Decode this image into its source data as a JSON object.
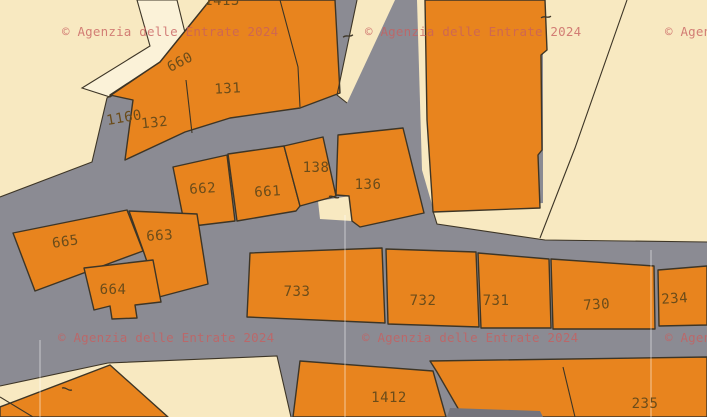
{
  "map": {
    "title": "cadastral-map",
    "watermark": {
      "text": "© Agenzia delle Entrate 2024",
      "positions": [
        [
          62,
          36
        ],
        [
          365,
          36
        ],
        [
          665,
          36
        ],
        [
          58,
          342
        ],
        [
          362,
          342
        ],
        [
          665,
          342
        ]
      ]
    },
    "colors": {
      "road": "#8b8b93",
      "road_dark": "#74747c",
      "land": "#f8e9c1",
      "land_light": "#fbf2d8",
      "parcel": "#e8841e",
      "boundary": "#3d3526",
      "label": "#6b4c1a",
      "watermark": "#c85f5f",
      "grid": "#ffffff"
    },
    "land_areas": [
      {
        "name": "land-area-northwest",
        "points": "0,0 210,0 160,62 107,98 92,162 0,197"
      },
      {
        "name": "land-area-top-wedge",
        "points": "357,0 395,0 347,103 337,95"
      },
      {
        "name": "land-area-road-sliver",
        "points": "417,0 425,0 433,208 422,170"
      },
      {
        "name": "land-area-east",
        "points": "543,0 707,0 707,242 545,240 437,224 433,211 543,203"
      },
      {
        "name": "land-area-notch",
        "points": "318,201 350,196 352,221 320,219"
      },
      {
        "name": "land-area-south",
        "points": "108,363 277,356 291,417 165,417 110,366"
      },
      {
        "name": "land-area-south-strip",
        "points": "0,386 108,363 112,367 0,406"
      }
    ],
    "corridors": [
      {
        "name": "footpath-corridor",
        "points": "137,0 177,0 190,53 162,63 110,97 82,88 150,46"
      }
    ],
    "parcels": [
      {
        "label": "131",
        "points": "210,0 335,0 340,93 300,108 230,118 185,132 125,160 133,100 110,95 160,62",
        "lx": 228,
        "ly": 93,
        "rot": -3
      },
      {
        "label": "",
        "points": "425,0 545,0 547,50 541,55 542,150 538,155 540,208 433,212 427,120",
        "lx": 0,
        "ly": 0,
        "rot": 0
      },
      {
        "label": "662",
        "points": "173,167 227,155 235,221 185,227",
        "lx": 203,
        "ly": 193,
        "rot": -4
      },
      {
        "label": "661",
        "points": "228,154 284,146 300,206 296,211 237,221",
        "lx": 268,
        "ly": 196,
        "rot": -4
      },
      {
        "label": "138",
        "points": "284,146 323,137 336,196 318,201 300,206",
        "lx": 316,
        "ly": 172,
        "rot": 0
      },
      {
        "label": "136",
        "points": "338,135 403,128 424,213 360,227 352,221 349,196 336,195",
        "lx": 368,
        "ly": 189,
        "rot": 0
      },
      {
        "label": "665",
        "points": "13,233 127,210 143,251 35,291",
        "lx": 66,
        "ly": 246,
        "rot": -8
      },
      {
        "label": "663",
        "points": "129,211 197,214 208,284 159,297 143,250",
        "lx": 160,
        "ly": 240,
        "rot": -4
      },
      {
        "label": "664",
        "points": "84,268 153,260 161,302 135,305 137,318 112,319 110,306 94,310",
        "lx": 113,
        "ly": 294,
        "rot": 0
      },
      {
        "label": "733",
        "points": "250,253 382,248 385,323 247,317",
        "lx": 297,
        "ly": 296,
        "rot": 0
      },
      {
        "label": "732",
        "points": "386,249 476,252 479,327 388,324",
        "lx": 423,
        "ly": 305,
        "rot": 0
      },
      {
        "label": "731",
        "points": "478,253 549,259 551,328 481,328",
        "lx": 496,
        "ly": 305,
        "rot": 0
      },
      {
        "label": "730",
        "points": "551,259 654,266 655,329 553,329",
        "lx": 597,
        "ly": 309,
        "rot": -4
      },
      {
        "label": "234",
        "points": "658,270 707,266 707,325 659,326",
        "lx": 675,
        "ly": 303,
        "rot": -4
      },
      {
        "label": "",
        "points": "0,407 110,365 168,417 0,417",
        "lx": 0,
        "ly": 0,
        "rot": 0
      },
      {
        "label": "1412",
        "points": "300,361 433,371 446,417 293,417",
        "lx": 389,
        "ly": 402,
        "rot": 0
      },
      {
        "label": "235",
        "points": "430,361 707,357 707,417 463,417 437,372",
        "lx": 645,
        "ly": 408,
        "rot": 0
      }
    ],
    "extra_labels": [
      {
        "text": "1413",
        "x": 222,
        "y": 5,
        "rot": 0
      },
      {
        "text": "660",
        "x": 182,
        "y": 66,
        "rot": -27
      },
      {
        "text": "1160",
        "x": 125,
        "y": 122,
        "rot": -10
      },
      {
        "text": "132",
        "x": 155,
        "y": 127,
        "rot": -6
      }
    ],
    "boundary_lines": [
      {
        "name": "boundary-line",
        "points": "210,0 160,62 107,98 92,162 0,197"
      },
      {
        "name": "boundary-line",
        "points": "357,0 337,95 347,103"
      },
      {
        "name": "boundary-line",
        "points": "627,0 575,148 540,238"
      },
      {
        "name": "boundary-line",
        "points": "433,211 437,224 545,240 707,242"
      },
      {
        "name": "boundary-line",
        "points": "280,0 298,67 300,107"
      },
      {
        "name": "boundary-line",
        "points": "186,80 192,133"
      },
      {
        "name": "boundary-line",
        "points": "0,397 33,417"
      },
      {
        "name": "boundary-line",
        "points": "563,367 575,417"
      },
      {
        "name": "boundary-line",
        "points": "108,363 277,356 291,417"
      },
      {
        "name": "boundary-line",
        "points": "0,386 108,363"
      }
    ],
    "survey_ticks": [
      {
        "x": 348,
        "y": 36,
        "rot": 75
      },
      {
        "x": 546,
        "y": 17,
        "rot": 80
      },
      {
        "x": 334,
        "y": 197,
        "rot": 95
      },
      {
        "x": 67,
        "y": 389,
        "rot": 100
      }
    ],
    "grid_lines": [
      {
        "x1": 40,
        "y1": 340,
        "x2": 40,
        "y2": 417
      },
      {
        "x1": 345,
        "y1": 215,
        "x2": 345,
        "y2": 417
      },
      {
        "x1": 651,
        "y1": 250,
        "x2": 651,
        "y2": 417
      }
    ],
    "road_patches": [
      {
        "name": "road-patch-dark",
        "points": "447,417 450,408 540,411 543,417"
      }
    ]
  }
}
